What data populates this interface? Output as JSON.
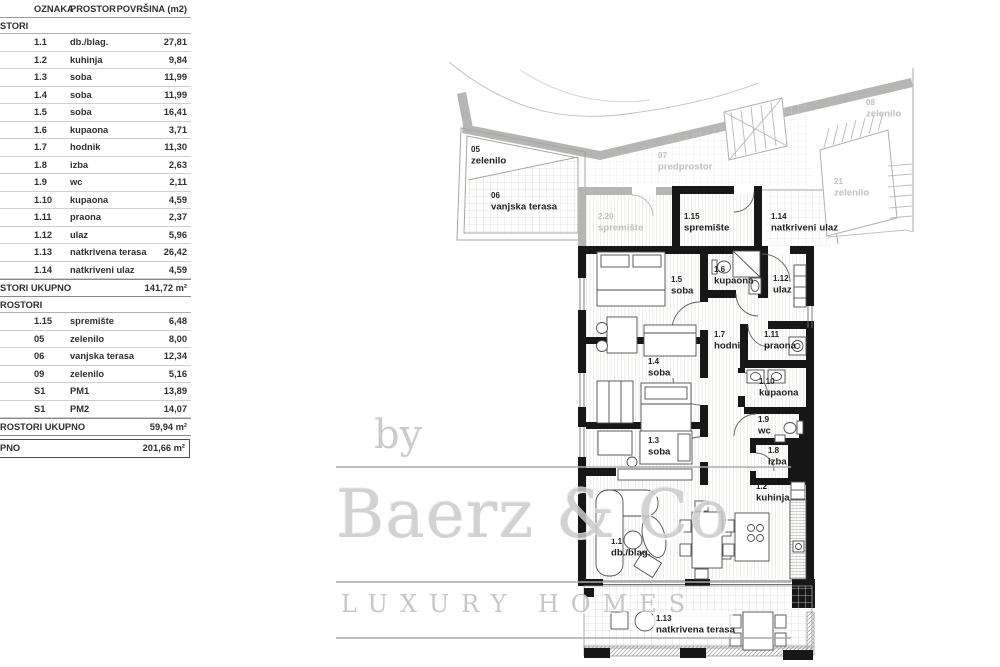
{
  "table": {
    "headers": {
      "oznaka": "OZNAKA",
      "prostor": "PROSTOR",
      "povrsina": "POVRŠINA (m2)"
    },
    "sections": [
      {
        "label": "STORI",
        "rows": [
          {
            "oznaka": "1.1",
            "prostor": "db./blag.",
            "povrsina": "27,81"
          },
          {
            "oznaka": "1.2",
            "prostor": "kuhinja",
            "povrsina": "9,84"
          },
          {
            "oznaka": "1.3",
            "prostor": "soba",
            "povrsina": "11,99"
          },
          {
            "oznaka": "1.4",
            "prostor": "soba",
            "povrsina": "11,99"
          },
          {
            "oznaka": "1.5",
            "prostor": "soba",
            "povrsina": "16,41"
          },
          {
            "oznaka": "1.6",
            "prostor": "kupaona",
            "povrsina": "3,71"
          },
          {
            "oznaka": "1.7",
            "prostor": "hodnik",
            "povrsina": "11,30"
          },
          {
            "oznaka": "1.8",
            "prostor": "izba",
            "povrsina": "2,63"
          },
          {
            "oznaka": "1.9",
            "prostor": "wc",
            "povrsina": "2,11"
          },
          {
            "oznaka": "1.10",
            "prostor": "kupaona",
            "povrsina": "4,59"
          },
          {
            "oznaka": "1.11",
            "prostor": "praona",
            "povrsina": "2,37"
          },
          {
            "oznaka": "1.12",
            "prostor": "ulaz",
            "povrsina": "5,96"
          },
          {
            "oznaka": "1.13",
            "prostor": "natkrivena terasa",
            "povrsina": "26,42"
          },
          {
            "oznaka": "1.14",
            "prostor": "natkriveni ulaz",
            "povrsina": "4,59"
          }
        ],
        "total_label": "STORI UKUPNO",
        "total_value": "141,72 m²"
      },
      {
        "label": "ROSTORI",
        "rows": [
          {
            "oznaka": "1.15",
            "prostor": "spremište",
            "povrsina": "6,48"
          },
          {
            "oznaka": "05",
            "prostor": "zelenilo",
            "povrsina": "8,00"
          },
          {
            "oznaka": "06",
            "prostor": "vanjska terasa",
            "povrsina": "12,34"
          },
          {
            "oznaka": "09",
            "prostor": "zelenilo",
            "povrsina": "5,16"
          },
          {
            "oznaka": "S1",
            "prostor": "PM1",
            "povrsina": "13,89"
          },
          {
            "oznaka": "S1",
            "prostor": "PM2",
            "povrsina": "14,07"
          }
        ],
        "total_label": "ROSTORI UKUPNO",
        "total_value": "59,94 m²"
      }
    ],
    "grand_total": {
      "label": "PNO",
      "value": "201,66 m²"
    }
  },
  "watermark": {
    "by": "by",
    "brand": "Baerz & Co",
    "tagline": "LUXURY HOMES"
  },
  "plan": {
    "rooms": [
      {
        "id": "05",
        "name": "zelenilo",
        "tone": "dark",
        "x": 471,
        "y": 152
      },
      {
        "id": "06",
        "name": "vanjska terasa",
        "tone": "dark",
        "x": 491,
        "y": 198
      },
      {
        "id": "07",
        "name": "predprostor",
        "tone": "muted",
        "x": 658,
        "y": 158
      },
      {
        "id": "2.20",
        "name": "spremište",
        "tone": "muted",
        "x": 598,
        "y": 219
      },
      {
        "id": "1.15",
        "name": "spremište",
        "tone": "dark",
        "x": 684,
        "y": 219
      },
      {
        "id": "08",
        "name": "zelenilo",
        "tone": "muted",
        "x": 866,
        "y": 105
      },
      {
        "id": "21",
        "name": "zelenilo",
        "tone": "muted",
        "x": 834,
        "y": 184
      },
      {
        "id": "1.14",
        "name": "natkriveni",
        "name2": "ulaz",
        "tone": "dark",
        "x": 771,
        "y": 219
      },
      {
        "id": "1.5",
        "name": "soba",
        "tone": "dark",
        "x": 671,
        "y": 282
      },
      {
        "id": "1.6",
        "name": "kupaona",
        "tone": "dark",
        "x": 714,
        "y": 272
      },
      {
        "id": "1.12",
        "name": "ulaz",
        "tone": "dark",
        "x": 773,
        "y": 281
      },
      {
        "id": "1.7",
        "name": "hodnik",
        "tone": "dark",
        "x": 714,
        "y": 337
      },
      {
        "id": "1.11",
        "name": "praona",
        "tone": "dark",
        "x": 764,
        "y": 337
      },
      {
        "id": "1.4",
        "name": "soba",
        "tone": "dark",
        "x": 648,
        "y": 364
      },
      {
        "id": "1.10",
        "name": "kupaona",
        "tone": "dark",
        "x": 759,
        "y": 384
      },
      {
        "id": "1.9",
        "name": "wc",
        "tone": "dark",
        "x": 758,
        "y": 422
      },
      {
        "id": "1.8",
        "name": "izba",
        "tone": "dark",
        "x": 768,
        "y": 453
      },
      {
        "id": "1.3",
        "name": "soba",
        "tone": "dark",
        "x": 648,
        "y": 443
      },
      {
        "id": "1.2",
        "name": "kuhinja",
        "tone": "dark",
        "x": 756,
        "y": 489
      },
      {
        "id": "1.1",
        "name": "db./blag.",
        "tone": "dark",
        "x": 611,
        "y": 544
      },
      {
        "id": "1.13",
        "name": "natkrivena terasa",
        "tone": "dark",
        "x": 656,
        "y": 621
      }
    ]
  }
}
